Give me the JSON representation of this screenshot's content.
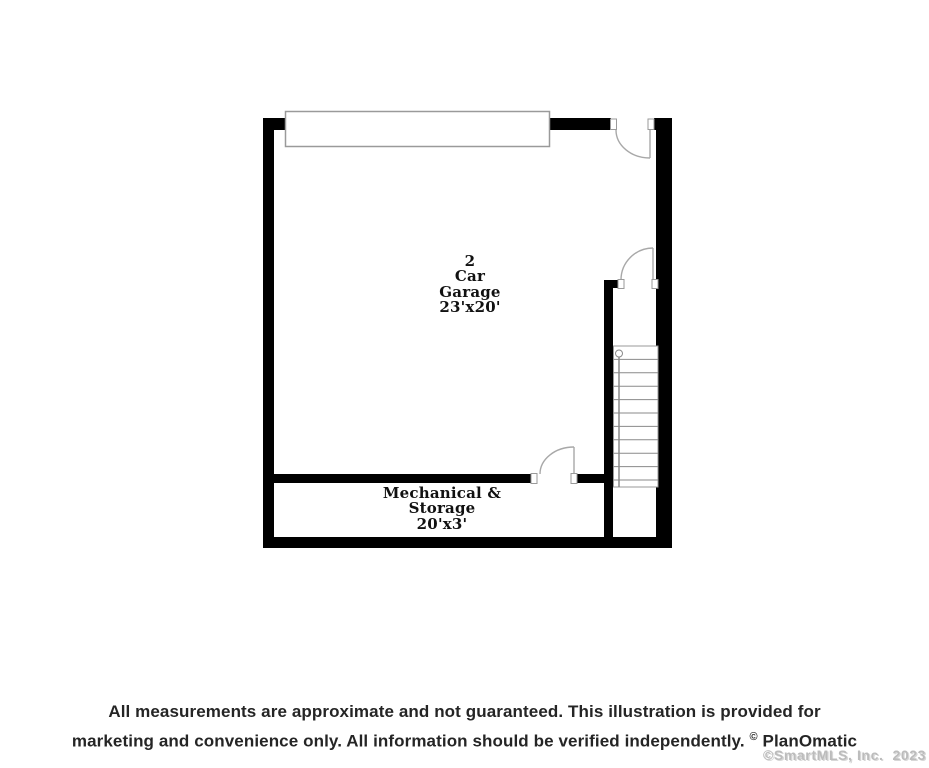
{
  "plan": {
    "garage_room": {
      "line1": "2",
      "line2": "Car",
      "line3": "Garage",
      "line4": "23'x20'"
    },
    "mechanical_room": {
      "line1": "Mechanical &",
      "line2": "Storage",
      "line3": "20'x3'"
    }
  },
  "footer": {
    "disclaimer_line1": "All measurements are approximate and not guaranteed. This illustration is provided for",
    "disclaimer_line2": "marketing and convenience only. All information should be verified independently. ",
    "copyright_symbol": "©",
    "brand": "PlanOmatic",
    "watermark": "©SmartMLS, Inc.  2023"
  },
  "colors": {
    "wall": "#000000",
    "line_gray": "#9a9a9a",
    "stair_line": "#8a8a8a",
    "label_text": "#111111",
    "disclaimer_text": "#252525",
    "watermark_gray": "#bcbcbc"
  }
}
